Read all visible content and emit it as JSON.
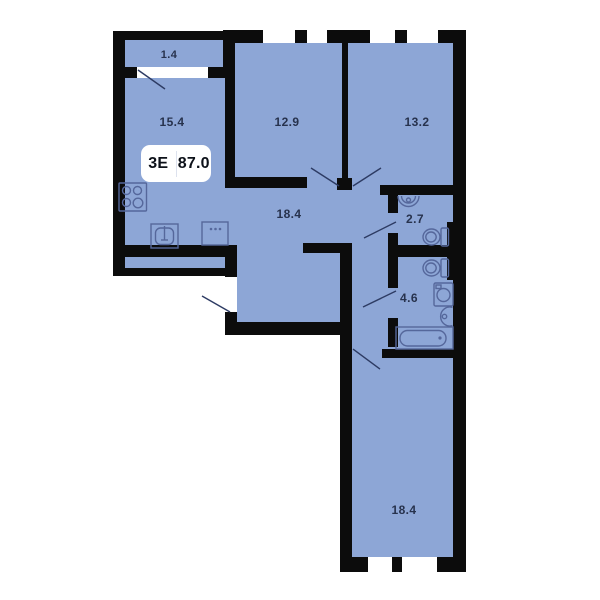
{
  "plan": {
    "title_badge": {
      "type": "3Е",
      "area": "87.0"
    },
    "rooms": [
      {
        "name": "balcony",
        "area": "1.4"
      },
      {
        "name": "kitchen-living-room",
        "area": "15.4"
      },
      {
        "name": "bedroom-1",
        "area": "12.9"
      },
      {
        "name": "bedroom-2",
        "area": "13.2"
      },
      {
        "name": "hallway",
        "area": "18.4"
      },
      {
        "name": "wc",
        "area": "2.7"
      },
      {
        "name": "bathroom",
        "area": "4.6"
      },
      {
        "name": "bedroom-3",
        "area": "18.4"
      }
    ],
    "fixtures": [
      "stove-icon",
      "kitchen-sink-icon",
      "kitchen-cabinet-icon",
      "wash-basin-icon",
      "toilet-icon",
      "toilet-icon",
      "washing-machine-icon",
      "basin-icon",
      "bathtub-icon"
    ],
    "colors": {
      "floor": "#8da6d6",
      "wall": "#0c0c0c",
      "fixture_stroke": "#55679b",
      "door_line": "#2d3b63",
      "label_text": "#27324d",
      "badge_bg": "#ffffff",
      "badge_text": "#0d1119",
      "badge_divider": "#dde2ee",
      "background": "#ffffff"
    }
  }
}
